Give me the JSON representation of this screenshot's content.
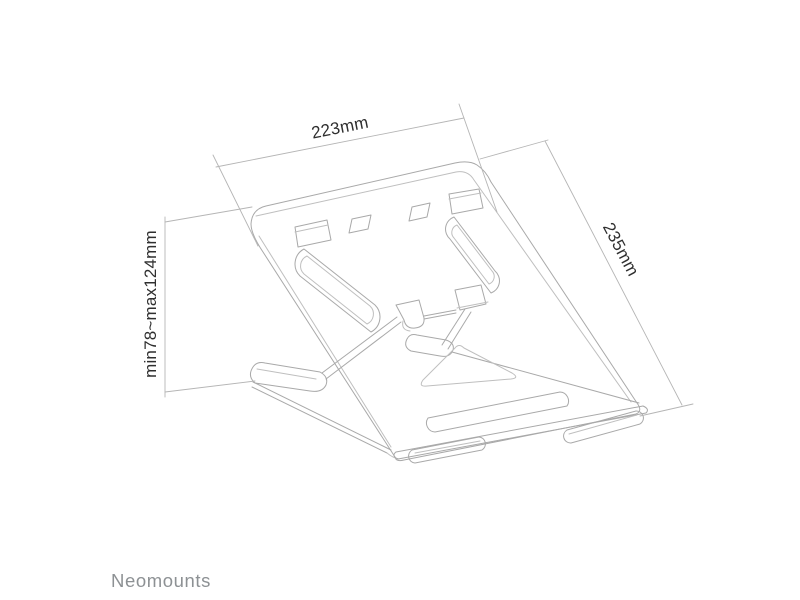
{
  "page": {
    "background_color": "#ffffff"
  },
  "product_drawing": {
    "description": "Folding laptop stand shown in perspective line drawing",
    "line_color": "#a9a9a9",
    "thin_line_color": "#bfbfbf"
  },
  "dimension_annotations": {
    "line_color": "#b5b5b5",
    "text_color": "#2f2f2f",
    "top_width_label": "223mm",
    "right_depth_label": "235mm",
    "left_height_label": "min78~max124mm"
  },
  "brand": {
    "wordmark": "Neomounts",
    "color": "#8d9194"
  }
}
